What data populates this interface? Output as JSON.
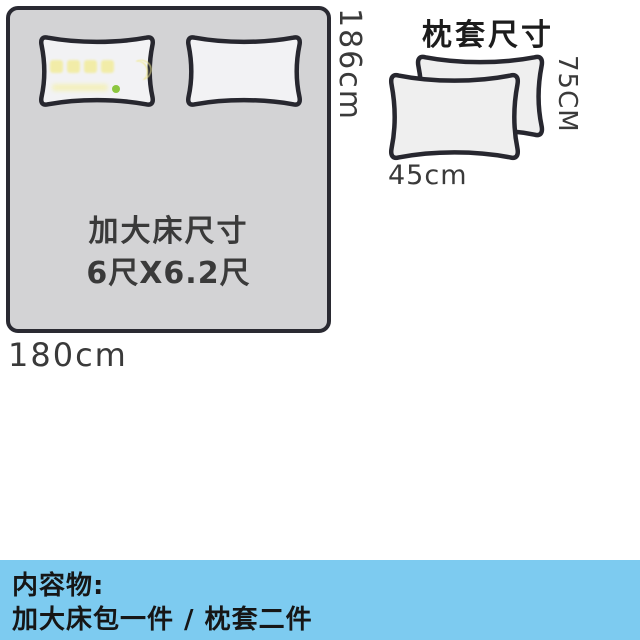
{
  "bed": {
    "title_line1": "加大床尺寸",
    "title_line2": "6尺X6.2尺",
    "height_label": "186cm",
    "width_label": "180cm"
  },
  "pillowcases": {
    "title": "枕套尺寸",
    "height_label": "75CM",
    "width_label": "45cm"
  },
  "contents": {
    "heading": "内容物:",
    "items": "加大床包一件 / 枕套二件"
  },
  "watermark": {
    "moon_glyph": "☽"
  },
  "colors": {
    "bed_fill": "#d3d3d5",
    "pillow_fill": "#f2f2f4",
    "outline": "#2a2a32",
    "bar_background": "#7dcbf0",
    "watermark_yellow": "#f0e98f",
    "watermark_green": "#8cc63f",
    "text_dark_gray": "#3a3a3a"
  }
}
